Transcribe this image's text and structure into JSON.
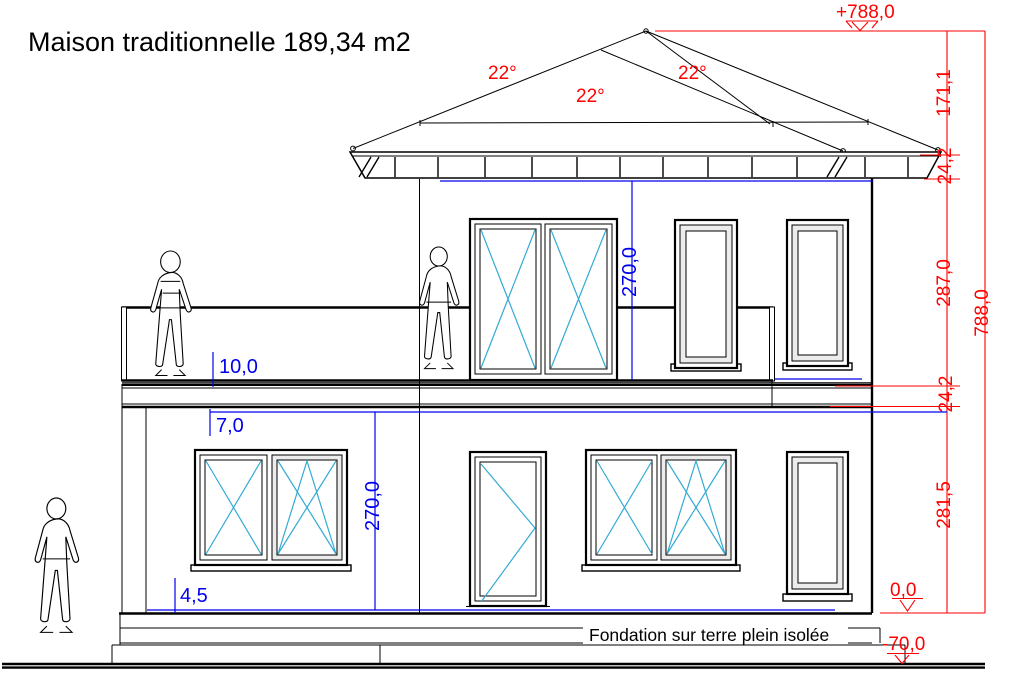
{
  "title": "Maison traditionnelle 189,34 m2",
  "foundation_note": "Fondation sur terre plein isolée",
  "roof": {
    "angle_left": "22°",
    "angle_middle": "22°",
    "angle_right": "22°"
  },
  "levels": {
    "top": "+788,0",
    "ground": "0,0",
    "foundation": "-70,0"
  },
  "red_dims": {
    "roof_height": "171,1",
    "eave_band": "24,2",
    "upper_storey": "287,0",
    "floor_slab": "24,2",
    "lower_storey": "281,5",
    "total": "788,0"
  },
  "blue_dims": {
    "upper_clear_height": "270,0",
    "lower_clear_height": "270,0",
    "railing_detail": "10,0",
    "slab_detail": "7,0",
    "plinth_detail": "4,5"
  },
  "colors": {
    "dimension_red": "#FF0000",
    "dimension_blue": "#0000EE",
    "opening_cyan": "#33AAD4",
    "drawing_black": "#000000",
    "background": "#FFFFFF"
  }
}
